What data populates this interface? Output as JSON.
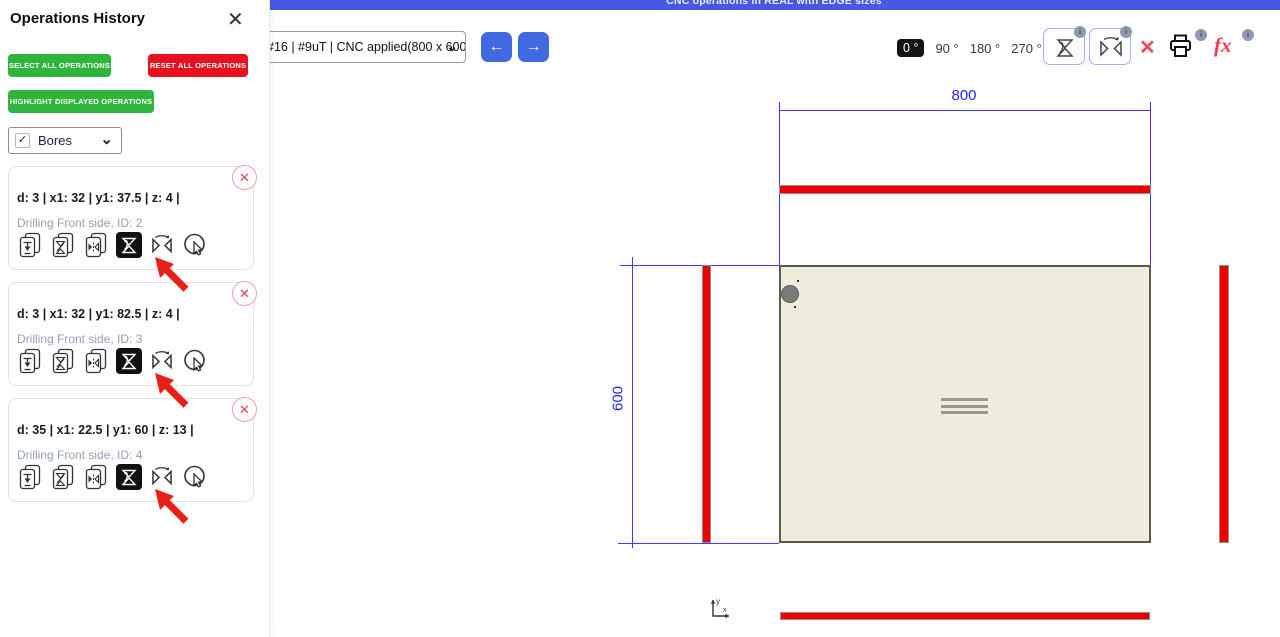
{
  "banner": {
    "text": "CNC operations in REAL with EDGE sizes"
  },
  "toolbar": {
    "board_select_value": "#16 | #9uT | CNC applied(800 x 600",
    "select_chevron": "⌄",
    "nav_back": "←",
    "nav_forward": "→",
    "rotations": [
      {
        "label": "0 °"
      },
      {
        "label": "90 °"
      },
      {
        "label": "180 °"
      },
      {
        "label": "270 °"
      }
    ],
    "selected_rotation": "0 °",
    "info_badge": "i",
    "clear_label": "✕",
    "fx_label": "fx"
  },
  "panel": {
    "title": "Operations History",
    "close_label": "✕",
    "select_all_label": "SELECT ALL OPERATIONS",
    "reset_all_label": "RESET ALL OPERATIONS",
    "highlight_label": "HIGHLIGHT DISPLAYED OPERATIONS",
    "filter": {
      "check": "✓",
      "label": "Bores",
      "chevron": "⌄"
    },
    "cards": [
      {
        "values": "d: 3 | x1: 32 | y1: 37.5 | z: 4 |",
        "subtitle": "Drilling Front side, ID: 2",
        "remove": "✕"
      },
      {
        "values": "d: 3 | x1: 32 | y1: 82.5 | z: 4 |",
        "subtitle": "Drilling Front side, ID: 3",
        "remove": "✕"
      },
      {
        "values": "d: 35 | x1: 22.5 | y1: 60 | z: 13 |",
        "subtitle": "Drilling Front side, ID: 4",
        "remove": "✕"
      }
    ]
  },
  "drawing": {
    "width_label": "800",
    "height_label": "600",
    "axis_x": "x",
    "axis_y": "y"
  },
  "colors": {
    "accent_blue": "#4759e3",
    "button_blue": "#4169e1",
    "green": "#2fb53c",
    "red": "#e8101f",
    "drawing_blue": "#2b2bf0",
    "bar_red": "#ee0000",
    "panel_beige": "#efeedd"
  }
}
